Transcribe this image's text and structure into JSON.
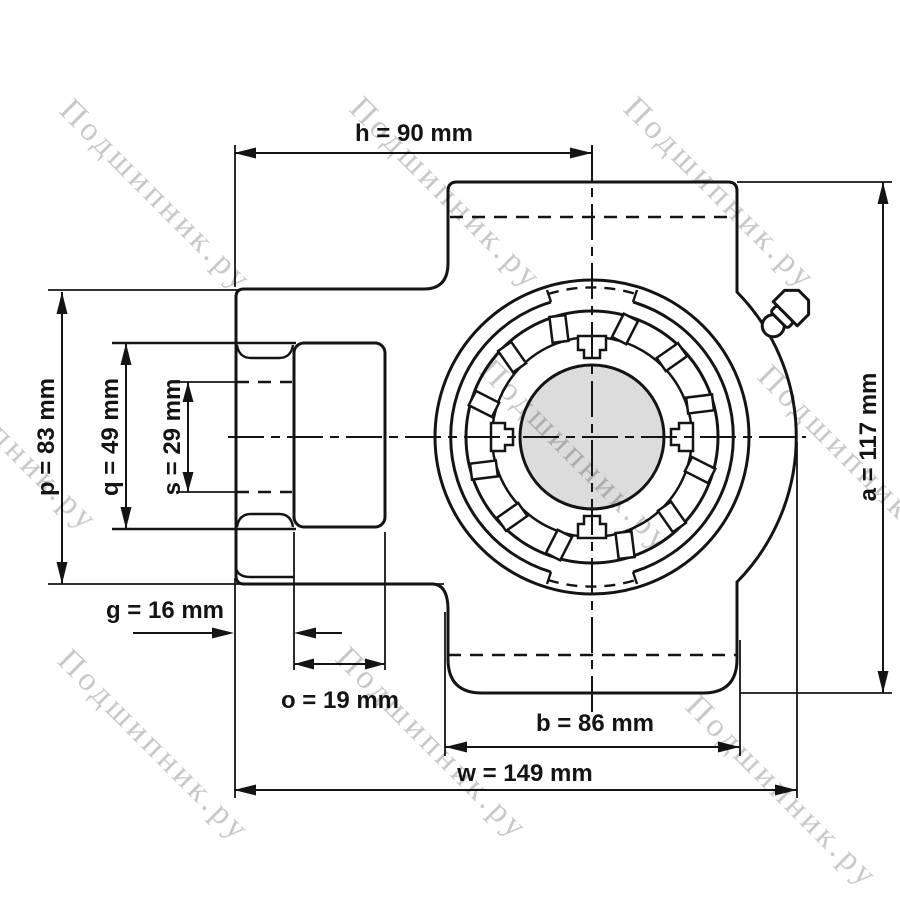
{
  "drawing": {
    "watermark_text": "Подшипник.ру",
    "dimensions": {
      "h": "h = 90 mm",
      "p": "p = 83 mm",
      "q": "q = 49 mm",
      "s": "s = 29 mm",
      "g": "g = 16 mm",
      "o": "o = 19 mm",
      "b": "b = 86 mm",
      "w": "w = 149 mm",
      "a": "a = 117 mm"
    },
    "colors": {
      "line": "#141414",
      "shaft_fill": "#dcdcdc",
      "watermark": "#c8c8c8",
      "background": "#ffffff"
    }
  }
}
